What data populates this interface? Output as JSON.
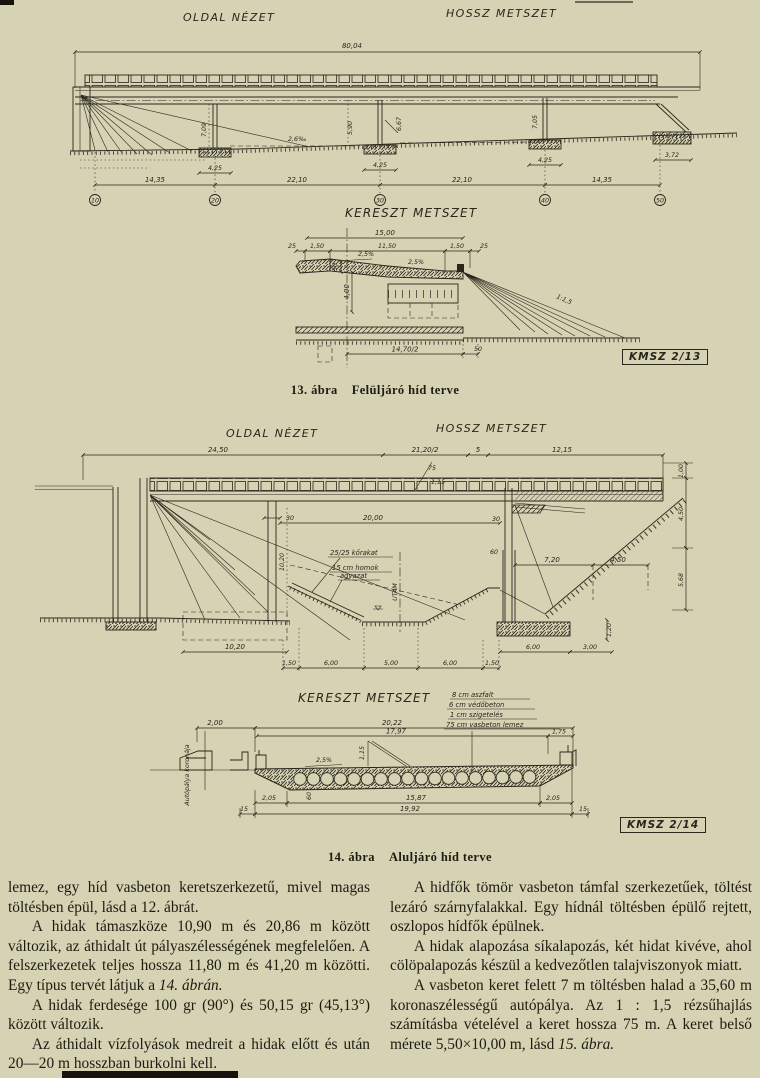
{
  "page": {
    "background": "#d6d2b4",
    "ink": "#2a261b"
  },
  "fig13": {
    "side_view_label": "OLDAL NÉZET",
    "long_section_label": "HOSSZ METSZET",
    "cross_section_label": "KERESZT METSZET",
    "stamp": "KMSZ 2/13",
    "caption_number": "13. ábra",
    "caption_title": "Felüljáró híd terve",
    "elevation": {
      "total_length": "80,04",
      "spans": [
        "14,35",
        "22,10",
        "22,10",
        "14,35"
      ],
      "supports": [
        "10",
        "20",
        "30",
        "40",
        "50"
      ],
      "pier_heights": [
        "7,09",
        "5,90",
        "6,67",
        "7,05"
      ],
      "footing_widths": [
        "4,25",
        "4,25",
        "4,25"
      ],
      "right_footing_width": "3,72",
      "grade": "2,6‰"
    },
    "cross_section": {
      "overall_width": "15,00",
      "edge_left": "25",
      "kerb_left": "1,50",
      "carriageway": "11,50",
      "kerb_right": "1,50",
      "edge_right": "25",
      "fall_left": "2,5%",
      "fall_right": "2,5%",
      "slab_thickness": "50",
      "frame_height": "4,00",
      "half_width": "14,70/2",
      "offset": "50",
      "slope": "1:1,5"
    }
  },
  "fig14": {
    "side_view_label": "OLDAL NÉZET",
    "long_section_label": "HOSSZ METSZET",
    "cross_section_label": "KERESZT METSZET",
    "stamp": "KMSZ 2/14",
    "caption_number": "14. ábra",
    "caption_title": "Aluljáró híd terve",
    "elevation": {
      "dim_left": "24,50",
      "dim_half": "21,20/2",
      "dim_gap": "5",
      "dim_right": "12,15",
      "kerb_a": "75",
      "kerb_b": "1,15",
      "clear_span": "20,00",
      "pier_width_top": "30",
      "wall_width_top": "30",
      "wall_width_mid": "60",
      "pier_height": "10,20",
      "footing_width": "10,20",
      "dim_720": "7,20",
      "dim_450": "4,50",
      "right_heights": [
        "1,00",
        "4,50",
        "5,68"
      ],
      "right_footing_a": "6,00",
      "right_footing_b": "3,00",
      "footing_depth": "1,20",
      "bottom_dims": [
        "1,50",
        "6,00",
        "5,00",
        "6,00",
        "1,50"
      ],
      "note_stone": "25/25 kőrakat",
      "note_sand_1": "15 cm homok",
      "note_sand_2": "ágyazat",
      "axis_label": "UTAM"
    },
    "cross_section": {
      "layers": [
        "8 cm aszfalt",
        "6 cm védőbeton",
        "1 cm szigetelés",
        "75 cm vasbeton lemez"
      ],
      "dim_200": "2,00",
      "dim_2022": "20,22",
      "dim_1797": "17,97",
      "dim_175": "1,75",
      "fall": "2,5%",
      "thickness": "60",
      "strut": "1,15",
      "bottom_a": "2,05",
      "bottom_b": "15,87",
      "bottom_c": "2,05",
      "bottom_total": "19,92",
      "edge_left": "15",
      "edge_right": "15",
      "crown_label": "Autópálya koronája"
    }
  },
  "text": {
    "col1": {
      "p1": "lemez, egy híd vasbeton keretszerkezetű, mivel magas töltésben épül, lásd a 12. ábrát.",
      "p2_main": "A hidak támaszköze 10,90 m és 20,86 m között változik, az áthidalt út pályaszélességének megfelelően. A felszerkezetek teljes hossza 11,80 m és 41,20 m közötti. Egy típus tervét látjuk a",
      "p2_ref": "14. ábrán.",
      "p3": "A hidak ferdesége 100 gr (90°) és 50,15 gr (45,13°) között változik.",
      "p4": "Az áthidalt vízfolyások medreit a hidak előtt és után 20—20 m hosszban burkolni kell."
    },
    "col2": {
      "p1": "A hidfők tömör vasbeton támfal szerkezetűek, töltést lezáró szárnyfalakkal. Egy hídnál töltésben épülő rejtett, oszlopos hídfők épülnek.",
      "p2": "A hidak alapozása síkalapozás, két hidat kivéve, ahol cölöpalapozás készül a kedvezőtlen talajviszonyok miatt.",
      "p3_main": "A vasbeton keret felett 7 m töltésben halad a 35,60 m koronaszélességű autópálya. Az 1 : 1,5 rézsűhajlás számításba vételével a keret hossza 75 m. A keret belső mérete 5,50×10,00 m, lásd",
      "p3_ref": "15. ábra."
    }
  }
}
